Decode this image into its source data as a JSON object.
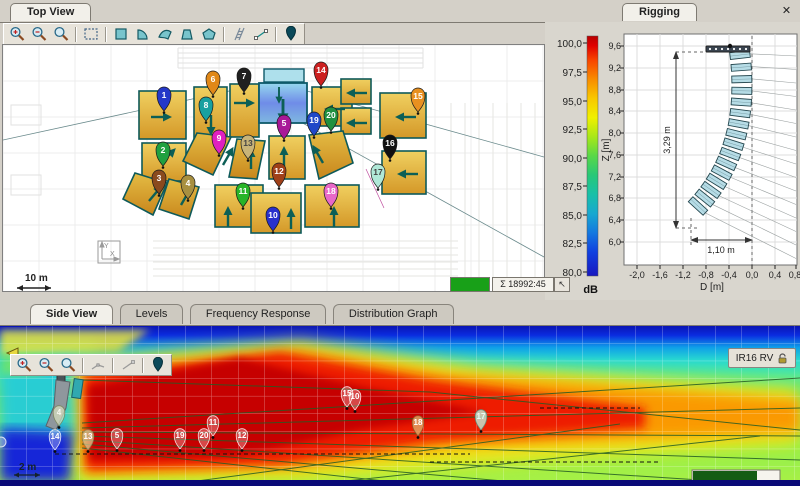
{
  "top_view": {
    "tab_label": "Top View",
    "scale_label": "10 m",
    "axis_x_label": "X",
    "axis_y_label": "Y",
    "status_sum": "Σ 18992:45",
    "status_pointer_glyph": "↖",
    "toolbar_icons": [
      "zoom-in-icon",
      "zoom-out-icon",
      "zoom-window-icon",
      "select-area-icon",
      "area-rect-icon",
      "area-quarter-icon",
      "area-curved-icon",
      "area-trapezoid-icon",
      "area-polygon-icon",
      "array-ladder-icon",
      "draw-line-icon",
      "source-pin-icon"
    ],
    "markers": [
      {
        "n": "1",
        "x": 161,
        "y": 58,
        "color": "#2438c8",
        "text": "#ffffff"
      },
      {
        "n": "2",
        "x": 160,
        "y": 113,
        "color": "#20a040",
        "text": "#ffffff"
      },
      {
        "n": "3",
        "x": 156,
        "y": 141,
        "color": "#8a4a1e",
        "text": "#ffffff"
      },
      {
        "n": "4",
        "x": 185,
        "y": 146,
        "color": "#a89040",
        "text": "#ffffff"
      },
      {
        "n": "5",
        "x": 281,
        "y": 86,
        "color": "#a81898",
        "text": "#ffffff"
      },
      {
        "n": "6",
        "x": 210,
        "y": 42,
        "color": "#e08818",
        "text": "#ffffff"
      },
      {
        "n": "7",
        "x": 241,
        "y": 39,
        "color": "#202020",
        "text": "#ffffff"
      },
      {
        "n": "8",
        "x": 203,
        "y": 68,
        "color": "#18a0a0",
        "text": "#ffffff"
      },
      {
        "n": "9",
        "x": 216,
        "y": 101,
        "color": "#e020c0",
        "text": "#ffffff"
      },
      {
        "n": "10",
        "x": 270,
        "y": 178,
        "color": "#2830cc",
        "text": "#ffffff"
      },
      {
        "n": "11",
        "x": 240,
        "y": 154,
        "color": "#28b428",
        "text": "#ffffff"
      },
      {
        "n": "12",
        "x": 276,
        "y": 134,
        "color": "#a04018",
        "text": "#ffffff"
      },
      {
        "n": "13",
        "x": 245,
        "y": 106,
        "color": "#c8b478",
        "text": "#444444"
      },
      {
        "n": "14",
        "x": 318,
        "y": 33,
        "color": "#cc2020",
        "text": "#ffffff"
      },
      {
        "n": "15",
        "x": 415,
        "y": 59,
        "color": "#e89020",
        "text": "#ffffff"
      },
      {
        "n": "16",
        "x": 387,
        "y": 106,
        "color": "#101010",
        "text": "#ffffff"
      },
      {
        "n": "17",
        "x": 375,
        "y": 135,
        "color": "#b0e8d8",
        "text": "#444444"
      },
      {
        "n": "18",
        "x": 328,
        "y": 154,
        "color": "#e868c8",
        "text": "#ffffff"
      },
      {
        "n": "19",
        "x": 311,
        "y": 83,
        "color": "#2048c8",
        "text": "#ffffff"
      },
      {
        "n": "20",
        "x": 328,
        "y": 78,
        "color": "#209040",
        "text": "#ffffff"
      }
    ]
  },
  "color_scale": {
    "unit": "dB",
    "tick_labels": [
      "100,0",
      "97,5",
      "95,0",
      "92,5",
      "90,0",
      "87,5",
      "85,0",
      "82,5",
      "80,0"
    ],
    "top_color": "#b80000",
    "bottom_color": "#1818c0"
  },
  "rigging": {
    "tab_label": "Rigging",
    "close_glyph": "✕",
    "z_axis_label": "Z [m]",
    "d_axis_label": "D [m]",
    "z_ticks": [
      "9,6",
      "9,2",
      "8,8",
      "8,4",
      "8,0",
      "7,6",
      "7,2",
      "6,8",
      "6,4",
      "6,0"
    ],
    "d_ticks": [
      "-2,0",
      "-1,6",
      "-1,2",
      "-0,8",
      "-0,4",
      "0,0",
      "0,4",
      "0,8"
    ],
    "height_dimension": "3,29 m",
    "width_dimension": "1,10 m"
  },
  "bottom_panel": {
    "tabs": [
      {
        "label": "Side View"
      },
      {
        "label": "Levels"
      },
      {
        "label": "Frequency Response"
      },
      {
        "label": "Distribution Graph"
      }
    ],
    "array_button_label": "IR16 RV",
    "lock_icon": "lock-open-icon",
    "scale_label": "2 m",
    "toolbar_icons": [
      "zoom-in-icon",
      "zoom-out-icon",
      "zoom-window-icon",
      "polyline-icon",
      "draw-line-icon",
      "source-pin-icon"
    ],
    "markers": [
      {
        "n": "4",
        "x": 59,
        "y": 93,
        "fill": "rgba(225,232,195,0.65)",
        "stroke": "rgba(120,130,90,0.9)",
        "text": "#f8f8f0"
      },
      {
        "n": "14",
        "x": 55,
        "y": 117,
        "fill": "rgba(255,255,255,0.28)",
        "stroke": "rgba(255,255,255,0.85)",
        "text": "#ffffff"
      },
      {
        "n": "13",
        "x": 88,
        "y": 117,
        "fill": "rgba(216,200,144,0.75)",
        "stroke": "rgba(150,130,80,0.9)",
        "text": "#ffffff"
      },
      {
        "n": "5",
        "x": 117,
        "y": 116,
        "fill": "rgba(255,255,255,0.28)",
        "stroke": "rgba(255,255,255,0.85)",
        "text": "#ffffff"
      },
      {
        "n": "19",
        "x": 180,
        "y": 116,
        "fill": "rgba(255,255,255,0.28)",
        "stroke": "rgba(255,255,255,0.85)",
        "text": "#ffffff"
      },
      {
        "n": "20",
        "x": 204,
        "y": 116,
        "fill": "rgba(255,255,255,0.28)",
        "stroke": "rgba(255,255,255,0.85)",
        "text": "#ffffff"
      },
      {
        "n": "11",
        "x": 213,
        "y": 103,
        "fill": "rgba(255,255,255,0.28)",
        "stroke": "rgba(255,255,255,0.85)",
        "text": "#ffffff"
      },
      {
        "n": "12",
        "x": 242,
        "y": 116,
        "fill": "rgba(255,255,255,0.28)",
        "stroke": "rgba(255,255,255,0.85)",
        "text": "#ffffff"
      },
      {
        "n": "15",
        "x": 347,
        "y": 74,
        "fill": "rgba(255,255,255,0.28)",
        "stroke": "rgba(255,255,255,0.85)",
        "text": "#ffffff"
      },
      {
        "n": "10",
        "x": 355,
        "y": 77,
        "fill": "rgba(255,255,255,0.28)",
        "stroke": "rgba(255,255,255,0.85)",
        "text": "#ffffff"
      },
      {
        "n": "18",
        "x": 418,
        "y": 103,
        "fill": "rgba(224,160,96,0.85)",
        "stroke": "rgba(140,90,40,0.9)",
        "text": "#ffffff"
      },
      {
        "n": "17",
        "x": 481,
        "y": 97,
        "fill": "rgba(192,236,216,0.8)",
        "stroke": "rgba(90,150,130,0.9)",
        "text": "#e8fff8"
      }
    ]
  }
}
